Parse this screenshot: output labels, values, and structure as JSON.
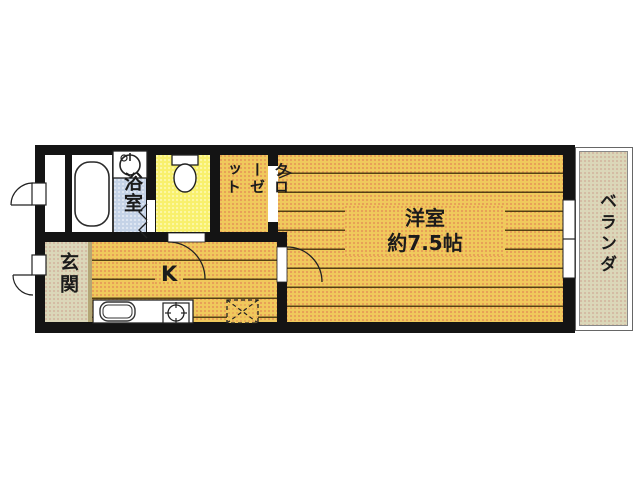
{
  "floorplan": {
    "type": "japanese-apartment-1K-floor-plan",
    "rooms": {
      "bathroom": {
        "label": "浴室"
      },
      "closet": {
        "label": "クローゼット"
      },
      "western_room": {
        "label": "洋室",
        "size": "約7.5帖"
      },
      "veranda": {
        "label": "ベランダ"
      },
      "entrance": {
        "label": "玄関"
      },
      "kitchen": {
        "label": "K"
      },
      "toilet": {
        "label": ""
      }
    },
    "icons": [
      "bathtub-icon",
      "washing-machine-icon",
      "toilet-icon",
      "kitchen-sink-icon",
      "stove-burner-icon",
      "refrigerator-space-icon",
      "sliding-window-icon",
      "door-swing-icon",
      "folding-door-icon"
    ],
    "colors": {
      "wall": "#141414",
      "room_floor": "#f0c95c",
      "toilet_floor": "#f8f06c",
      "washroom_floor": "#c5d3e7",
      "entrance_floor": "#dbd7b9",
      "veranda_floor": "#dbd7b9",
      "background": "#ffffff"
    }
  }
}
